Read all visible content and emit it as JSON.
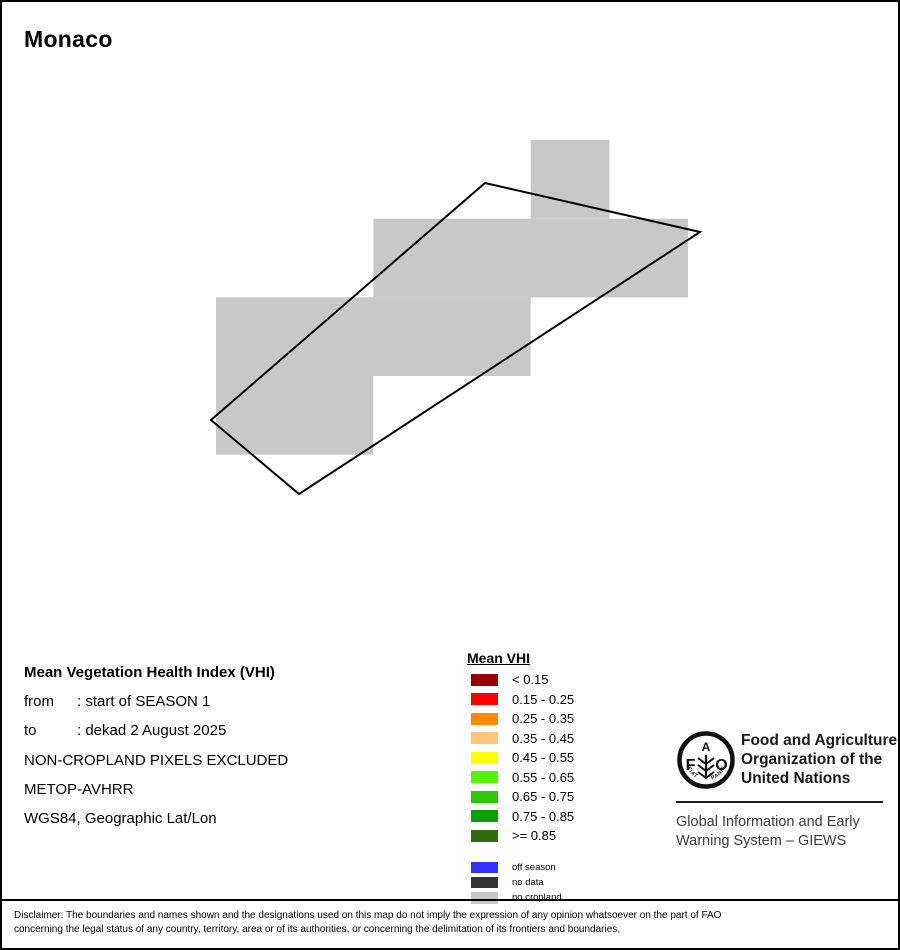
{
  "title": "Monaco",
  "map": {
    "colors": {
      "no_cropland": "#C8C8C8",
      "boundary": "#000000"
    },
    "cells": [
      {
        "x": 528.7,
        "y": 138.0,
        "w": 78.7,
        "h": 78.7
      },
      {
        "x": 371.3,
        "y": 216.7,
        "w": 314.7,
        "h": 78.7
      },
      {
        "x": 214.0,
        "y": 295.3,
        "w": 314.7,
        "h": 78.7
      },
      {
        "x": 214.0,
        "y": 374.0,
        "w": 157.3,
        "h": 78.7
      }
    ],
    "outline_points": "483,181 698,230 297,492 209,418"
  },
  "info": {
    "heading": "Mean Vegetation Health Index (VHI)",
    "rows": [
      {
        "label": "from",
        "value": ": start of SEASON 1"
      },
      {
        "label": "to",
        "value": ": dekad 2 August 2025"
      }
    ],
    "lines": [
      "NON-CROPLAND PIXELS EXCLUDED",
      "METOP-AVHRR",
      "WGS84, Geographic Lat/Lon"
    ]
  },
  "legend": {
    "title": "Mean VHI",
    "vhi_classes": [
      {
        "label": "< 0.15",
        "color": "#9B0000"
      },
      {
        "label": "0.15 - 0.25",
        "color": "#FF0000"
      },
      {
        "label": "0.25 - 0.35",
        "color": "#FF8C00"
      },
      {
        "label": "0.35 - 0.45",
        "color": "#FDC879"
      },
      {
        "label": "0.45 - 0.55",
        "color": "#FFFF00"
      },
      {
        "label": "0.55 - 0.65",
        "color": "#57F20A"
      },
      {
        "label": "0.65 - 0.75",
        "color": "#2EC806"
      },
      {
        "label": "0.75 - 0.85",
        "color": "#07A007"
      },
      {
        "label": ">= 0.85",
        "color": "#2F6B12"
      }
    ],
    "other_classes": [
      {
        "label": "off season",
        "color": "#3333FF"
      },
      {
        "label": "no data",
        "color": "#333333"
      },
      {
        "label": "no cropland",
        "color": "#C8C8C8"
      }
    ]
  },
  "fao": {
    "logo": {
      "letter_f": "F",
      "letter_a": "A",
      "letter_o": "O",
      "motto_left": "FIAT",
      "motto_right": "PANIS"
    },
    "org_lines": [
      "Food and Agriculture",
      "Organization of the",
      "United Nations"
    ],
    "giews_lines": [
      "Global Information and Early",
      "Warning System – GIEWS"
    ]
  },
  "disclaimer": {
    "lines": [
      "Disclaimer: The boundaries and names shown and the designations used on this map do not imply the expression of any opinion whatsoever on the part of FAO",
      "concerning the legal status of any country, territory, area or of its authorities, or concerning the delimitation of its frontiers and boundaries."
    ]
  }
}
